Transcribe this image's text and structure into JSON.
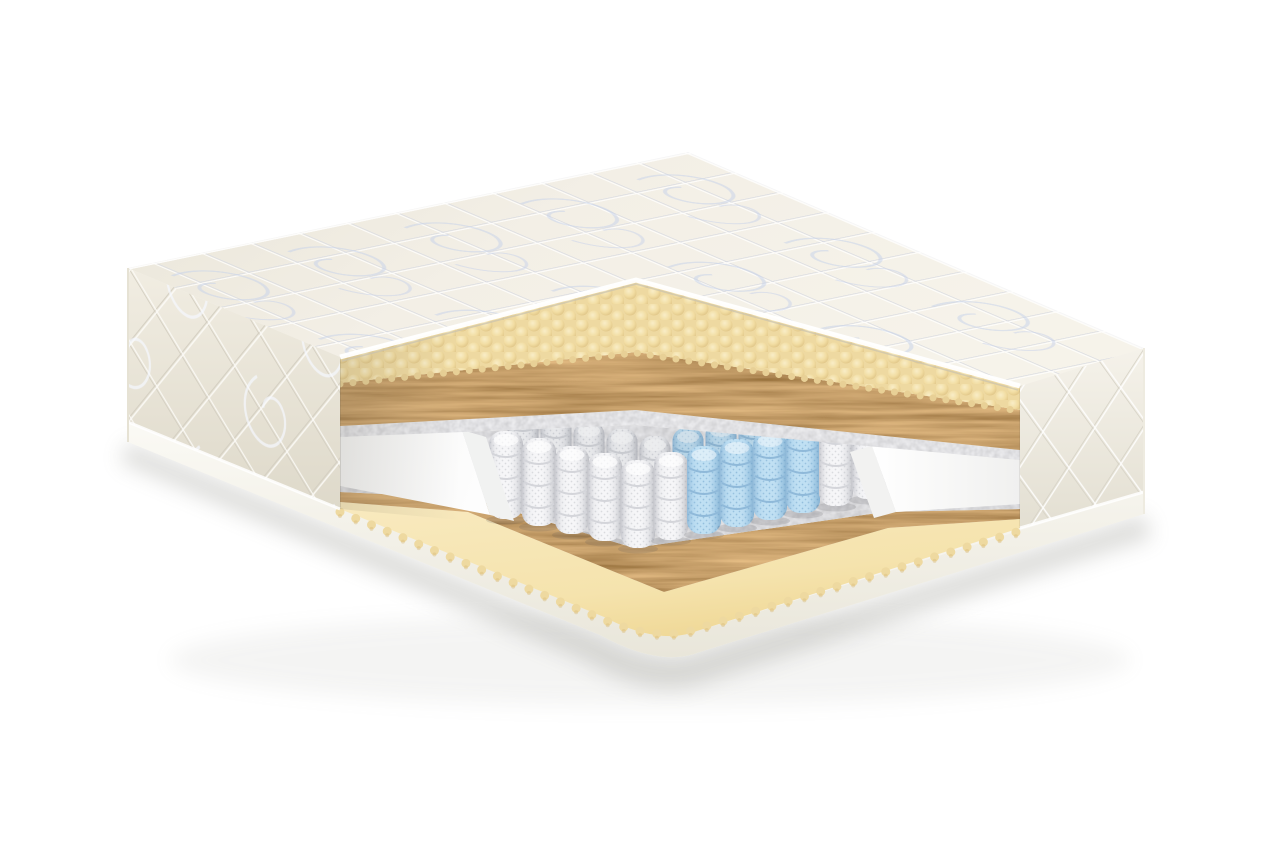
{
  "scene": {
    "type": "mattress-cutaway-product-render",
    "background_color": "#ffffff",
    "shadow_color": "#8a8a82"
  },
  "colors": {
    "quilt_cover": "#f2eee4",
    "quilt_seam": "#d7dae2",
    "quilt_swirl_print": "#c8d2e9",
    "side_panel": "#efebe0",
    "side_seam": "#d4cfc2",
    "bottom_rim": "#fbfaf5",
    "egg_crate_foam": "#f0dca4",
    "egg_crate_highlight": "#faf0cd",
    "egg_crate_shadow": "#d9bc7c",
    "coconut_coir": "#7c4f23",
    "felt": "#b0b1b4",
    "pocket_spring_white": "#f6f6f8",
    "pocket_spring_white_mesh": "#d9dade",
    "pocket_spring_blue": "#bedff3",
    "pocket_spring_blue_mesh": "#92bedd",
    "foam_rail": "#fcfcfd",
    "base_foam_sheet": "#f5e3ad"
  },
  "layers": [
    {
      "name": "quilted-cover-top",
      "color": "#f2eee4"
    },
    {
      "name": "quilted-side-border",
      "color": "#efebe0"
    },
    {
      "name": "egg-crate-foam-top",
      "color": "#f0dca4"
    },
    {
      "name": "coconut-coir-top",
      "color": "#7c4f23"
    },
    {
      "name": "felt-top",
      "color": "#b0b1b4"
    },
    {
      "name": "pocket-spring-block",
      "color": "#f6f6f8"
    },
    {
      "name": "comfort-zone-springs",
      "color": "#bedff3"
    },
    {
      "name": "foam-encasement-rail-left",
      "color": "#fcfcfd"
    },
    {
      "name": "foam-encasement-rail-right",
      "color": "#fcfcfd"
    },
    {
      "name": "felt-bottom",
      "color": "#b0b1b4"
    },
    {
      "name": "coconut-coir-bottom",
      "color": "#7c4f23"
    },
    {
      "name": "base-foam-sheet",
      "color": "#f5e3ad"
    },
    {
      "name": "bottom-rim",
      "color": "#fbfaf5"
    }
  ],
  "springs": {
    "front_rank": {
      "width": 34,
      "height": 88,
      "items": [
        {
          "x": 506,
          "y": 519,
          "c": "w"
        },
        {
          "x": 539,
          "y": 526,
          "c": "w"
        },
        {
          "x": 572,
          "y": 534,
          "c": "w"
        },
        {
          "x": 605,
          "y": 541,
          "c": "w"
        },
        {
          "x": 638,
          "y": 548,
          "c": "w"
        },
        {
          "x": 671,
          "y": 540,
          "c": "w"
        },
        {
          "x": 704,
          "y": 534,
          "c": "b"
        },
        {
          "x": 737,
          "y": 527,
          "c": "b"
        },
        {
          "x": 770,
          "y": 520,
          "c": "b"
        },
        {
          "x": 803,
          "y": 513,
          "c": "b"
        },
        {
          "x": 836,
          "y": 506,
          "c": "w"
        },
        {
          "x": 869,
          "y": 499,
          "c": "w"
        }
      ]
    },
    "back_rank": {
      "width": 31,
      "height": 80,
      "items": [
        {
          "x": 523,
          "y": 487,
          "c": "w"
        },
        {
          "x": 556,
          "y": 494,
          "c": "w"
        },
        {
          "x": 589,
          "y": 502,
          "c": "w"
        },
        {
          "x": 622,
          "y": 509,
          "c": "w"
        },
        {
          "x": 655,
          "y": 516,
          "c": "w"
        },
        {
          "x": 688,
          "y": 508,
          "c": "b"
        },
        {
          "x": 721,
          "y": 502,
          "c": "b"
        },
        {
          "x": 754,
          "y": 495,
          "c": "b"
        },
        {
          "x": 787,
          "y": 488,
          "c": "b"
        },
        {
          "x": 820,
          "y": 481,
          "c": "w"
        },
        {
          "x": 853,
          "y": 474,
          "c": "w"
        }
      ]
    }
  }
}
